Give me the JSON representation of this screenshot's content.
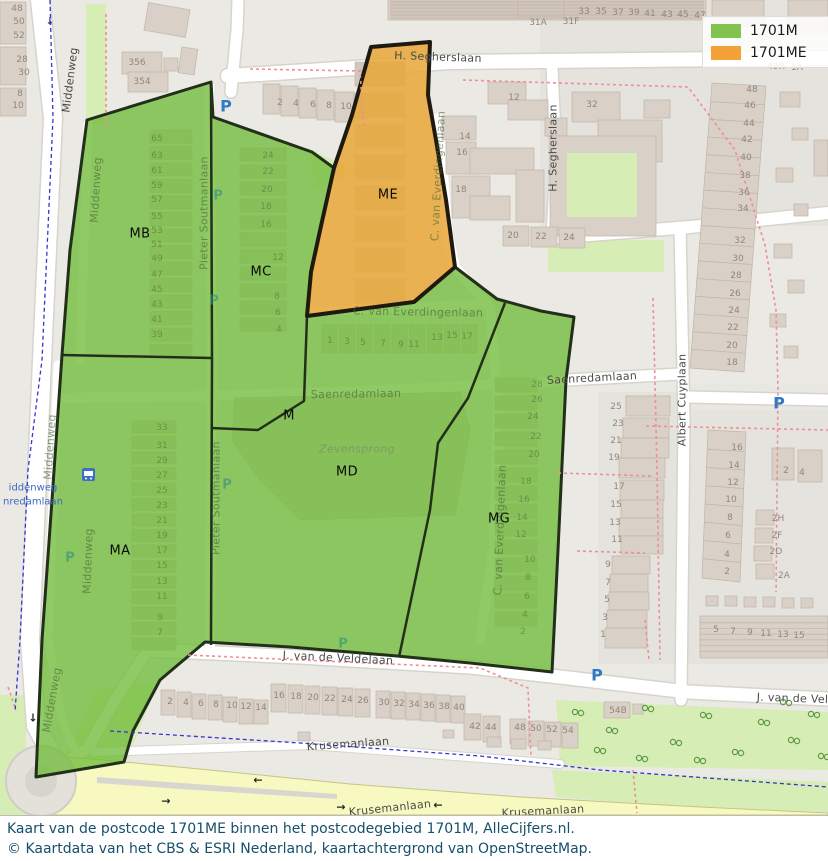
{
  "legend": {
    "items": [
      {
        "label": "1701M",
        "color": "#82c24e"
      },
      {
        "label": "1701ME",
        "color": "#f4a137"
      }
    ]
  },
  "caption": {
    "line1": "Kaart van de postcode 1701ME binnen het postcodegebied 1701M, AlleCijfers.nl.",
    "line2": "© Kaartdata van het CBS & ESRI Nederland, kaartachtergrond van OpenStreetMap."
  },
  "colors": {
    "area_1701M": "#74bd3f",
    "area_1701ME": "#e8a93c",
    "boundary_dark": "#22301a",
    "postcode_boundary_dashed": "#ef8e97",
    "cycleway_dashed": "#3535cf",
    "caption_text": "#16506b",
    "parking_icon": "#2e7ac5"
  },
  "regions": [
    {
      "code": "MB",
      "x": 140,
      "y": 234
    },
    {
      "code": "MC",
      "x": 261,
      "y": 272
    },
    {
      "code": "ME",
      "x": 388,
      "y": 195
    },
    {
      "code": "M",
      "x": 289,
      "y": 416
    },
    {
      "code": "MD",
      "x": 347,
      "y": 472
    },
    {
      "code": "MA",
      "x": 120,
      "y": 551
    },
    {
      "code": "MG",
      "x": 499,
      "y": 519
    }
  ],
  "streets": [
    {
      "t": "Middenweg",
      "x": 70,
      "y": 80,
      "r": -83,
      "v": "main"
    },
    {
      "t": "Middenweg",
      "x": 96,
      "y": 190,
      "r": -87,
      "v": "faint"
    },
    {
      "t": "Middenweg",
      "x": 50,
      "y": 447,
      "r": -86,
      "v": "faint"
    },
    {
      "t": "Middenweg",
      "x": 88,
      "y": 561,
      "r": -88,
      "v": "faint"
    },
    {
      "t": "Middenweg",
      "x": 52,
      "y": 700,
      "r": -80,
      "v": "faint"
    },
    {
      "t": "H. Segherslaan",
      "x": 438,
      "y": 57,
      "r": 2,
      "v": "main"
    },
    {
      "t": "H. Segherslaan",
      "x": 553,
      "y": 148,
      "r": -90,
      "v": "main"
    },
    {
      "t": "Pieter Soutmanlaan",
      "x": 204,
      "y": 213,
      "r": -90,
      "v": "faint"
    },
    {
      "t": "Pieter Soutmanlaan",
      "x": 216,
      "y": 498,
      "r": -90,
      "v": "faint"
    },
    {
      "t": "C. van Everdingenlaan",
      "x": 438,
      "y": 176,
      "r": -87,
      "v": "faint"
    },
    {
      "t": "C. van Everdingenlaan",
      "x": 418,
      "y": 312,
      "r": 1,
      "v": "faint"
    },
    {
      "t": "C. van Everdingenlaan",
      "x": 500,
      "y": 530,
      "r": -88,
      "v": "faint"
    },
    {
      "t": "Saenredamlaan",
      "x": 356,
      "y": 394,
      "r": -1,
      "v": "faint"
    },
    {
      "t": "Saenredamlaan",
      "x": 592,
      "y": 378,
      "r": -3,
      "v": "main"
    },
    {
      "t": "Albert Cuyplaan",
      "x": 682,
      "y": 400,
      "r": -90,
      "v": "main"
    },
    {
      "t": "Zevensprong",
      "x": 357,
      "y": 449,
      "r": 0,
      "v": "place"
    },
    {
      "t": "J. van de Veldelaan",
      "x": 338,
      "y": 658,
      "r": 3,
      "v": "main"
    },
    {
      "t": "J. van de Veldelaan",
      "x": 812,
      "y": 699,
      "r": 2,
      "v": "main"
    },
    {
      "t": "Krusemanlaan",
      "x": 348,
      "y": 744,
      "r": -4,
      "v": "main"
    },
    {
      "t": "Krusemanlaan",
      "x": 390,
      "y": 808,
      "r": -6,
      "v": "main"
    },
    {
      "t": "Krusemanlaan",
      "x": 543,
      "y": 811,
      "r": -3,
      "v": "main"
    }
  ],
  "bus_stop": {
    "line1": "iddenweg",
    "line2": "nredamlaan"
  },
  "pois": [
    {
      "t": "P",
      "x": 226,
      "y": 106,
      "cls": "pblue",
      "name": "parking-icon"
    },
    {
      "t": "P",
      "x": 779,
      "y": 403,
      "cls": "pblue",
      "name": "parking-icon"
    },
    {
      "t": "P",
      "x": 597,
      "y": 675,
      "cls": "pblue",
      "name": "parking-icon"
    },
    {
      "t": "P",
      "x": 218,
      "y": 196,
      "cls": "pteal",
      "name": "parking-icon"
    },
    {
      "t": "P",
      "x": 214,
      "y": 301,
      "cls": "pteal",
      "name": "parking-icon"
    },
    {
      "t": "P",
      "x": 227,
      "y": 485,
      "cls": "pteal",
      "name": "parking-icon"
    },
    {
      "t": "P",
      "x": 70,
      "y": 558,
      "cls": "pteal",
      "name": "parking-icon"
    },
    {
      "t": "P",
      "x": 343,
      "y": 644,
      "cls": "pteal",
      "name": "parking-icon"
    },
    {
      "t": "←",
      "x": 258,
      "y": 780,
      "cls": "arrow",
      "name": "oneway-arrow-icon"
    },
    {
      "t": "→",
      "x": 166,
      "y": 801,
      "cls": "arrow",
      "name": "oneway-arrow-icon"
    },
    {
      "t": "←",
      "x": 438,
      "y": 805,
      "cls": "arrow",
      "name": "oneway-arrow-icon"
    },
    {
      "t": "→",
      "x": 341,
      "y": 807,
      "cls": "arrow",
      "name": "oneway-arrow-icon"
    },
    {
      "t": "↓",
      "x": 33,
      "y": 718,
      "cls": "arrow",
      "name": "oneway-arrow-icon"
    },
    {
      "t": "↓",
      "x": 50,
      "y": 22,
      "cls": "arrowblue",
      "name": "path-arrow-icon"
    }
  ],
  "house_numbers": [
    {
      "t": "48",
      "x": 17,
      "y": 9
    },
    {
      "t": "50",
      "x": 19,
      "y": 22
    },
    {
      "t": "52",
      "x": 19,
      "y": 36
    },
    {
      "t": "28",
      "x": 22,
      "y": 60
    },
    {
      "t": "30",
      "x": 24,
      "y": 73
    },
    {
      "t": "8",
      "x": 20,
      "y": 94
    },
    {
      "t": "10",
      "x": 18,
      "y": 106
    },
    {
      "t": "356",
      "x": 137,
      "y": 63
    },
    {
      "t": "354",
      "x": 142,
      "y": 82
    },
    {
      "t": "2",
      "x": 280,
      "y": 103
    },
    {
      "t": "4",
      "x": 296,
      "y": 104
    },
    {
      "t": "6",
      "x": 313,
      "y": 105
    },
    {
      "t": "8",
      "x": 329,
      "y": 106
    },
    {
      "t": "10",
      "x": 346,
      "y": 107
    },
    {
      "t": "31A",
      "x": 538,
      "y": 23
    },
    {
      "t": "31F",
      "x": 571,
      "y": 22
    },
    {
      "t": "33",
      "x": 584,
      "y": 12
    },
    {
      "t": "35",
      "x": 601,
      "y": 12
    },
    {
      "t": "37",
      "x": 618,
      "y": 13
    },
    {
      "t": "39",
      "x": 634,
      "y": 13
    },
    {
      "t": "41",
      "x": 650,
      "y": 14
    },
    {
      "t": "43",
      "x": 667,
      "y": 15
    },
    {
      "t": "45",
      "x": 683,
      "y": 15
    },
    {
      "t": "47",
      "x": 700,
      "y": 16
    },
    {
      "t": "49R",
      "x": 776,
      "y": 67
    },
    {
      "t": "1A",
      "x": 797,
      "y": 68
    },
    {
      "t": "12",
      "x": 514,
      "y": 98
    },
    {
      "t": "32",
      "x": 592,
      "y": 105
    },
    {
      "t": "14",
      "x": 465,
      "y": 137
    },
    {
      "t": "16",
      "x": 462,
      "y": 153
    },
    {
      "t": "18",
      "x": 461,
      "y": 190
    },
    {
      "t": "20",
      "x": 513,
      "y": 236
    },
    {
      "t": "22",
      "x": 541,
      "y": 237
    },
    {
      "t": "24",
      "x": 569,
      "y": 238
    },
    {
      "t": "48",
      "x": 752,
      "y": 90
    },
    {
      "t": "46",
      "x": 750,
      "y": 106
    },
    {
      "t": "44",
      "x": 749,
      "y": 124
    },
    {
      "t": "42",
      "x": 747,
      "y": 140
    },
    {
      "t": "40",
      "x": 746,
      "y": 158
    },
    {
      "t": "38",
      "x": 745,
      "y": 176
    },
    {
      "t": "36",
      "x": 744,
      "y": 193
    },
    {
      "t": "34",
      "x": 743,
      "y": 209
    },
    {
      "t": "32",
      "x": 740,
      "y": 241
    },
    {
      "t": "30",
      "x": 738,
      "y": 259
    },
    {
      "t": "28",
      "x": 736,
      "y": 276
    },
    {
      "t": "26",
      "x": 735,
      "y": 294
    },
    {
      "t": "24",
      "x": 734,
      "y": 311
    },
    {
      "t": "22",
      "x": 733,
      "y": 328
    },
    {
      "t": "20",
      "x": 732,
      "y": 346
    },
    {
      "t": "18",
      "x": 732,
      "y": 363
    },
    {
      "t": "25",
      "x": 616,
      "y": 407
    },
    {
      "t": "23",
      "x": 618,
      "y": 424
    },
    {
      "t": "21",
      "x": 616,
      "y": 441
    },
    {
      "t": "19",
      "x": 614,
      "y": 458
    },
    {
      "t": "17",
      "x": 619,
      "y": 487
    },
    {
      "t": "15",
      "x": 616,
      "y": 505
    },
    {
      "t": "13",
      "x": 615,
      "y": 523
    },
    {
      "t": "11",
      "x": 617,
      "y": 540
    },
    {
      "t": "9",
      "x": 608,
      "y": 565
    },
    {
      "t": "7",
      "x": 608,
      "y": 583
    },
    {
      "t": "5",
      "x": 607,
      "y": 600
    },
    {
      "t": "3",
      "x": 605,
      "y": 618
    },
    {
      "t": "1",
      "x": 603,
      "y": 635
    },
    {
      "t": "16",
      "x": 737,
      "y": 448
    },
    {
      "t": "14",
      "x": 734,
      "y": 466
    },
    {
      "t": "12",
      "x": 733,
      "y": 483
    },
    {
      "t": "10",
      "x": 731,
      "y": 500
    },
    {
      "t": "8",
      "x": 730,
      "y": 518
    },
    {
      "t": "6",
      "x": 728,
      "y": 536
    },
    {
      "t": "4",
      "x": 727,
      "y": 555
    },
    {
      "t": "2",
      "x": 727,
      "y": 572
    },
    {
      "t": "2H",
      "x": 778,
      "y": 519
    },
    {
      "t": "2F",
      "x": 777,
      "y": 536
    },
    {
      "t": "2D",
      "x": 776,
      "y": 552
    },
    {
      "t": "2A",
      "x": 784,
      "y": 576
    },
    {
      "t": "2",
      "x": 786,
      "y": 471
    },
    {
      "t": "4",
      "x": 802,
      "y": 473
    },
    {
      "t": "5",
      "x": 716,
      "y": 630
    },
    {
      "t": "7",
      "x": 733,
      "y": 632
    },
    {
      "t": "9",
      "x": 750,
      "y": 633
    },
    {
      "t": "11",
      "x": 766,
      "y": 634
    },
    {
      "t": "13",
      "x": 783,
      "y": 635
    },
    {
      "t": "15",
      "x": 799,
      "y": 636
    },
    {
      "t": "2",
      "x": 170,
      "y": 702
    },
    {
      "t": "4",
      "x": 186,
      "y": 703
    },
    {
      "t": "6",
      "x": 201,
      "y": 704
    },
    {
      "t": "8",
      "x": 216,
      "y": 705
    },
    {
      "t": "10",
      "x": 232,
      "y": 706
    },
    {
      "t": "12",
      "x": 246,
      "y": 707
    },
    {
      "t": "14",
      "x": 261,
      "y": 708
    },
    {
      "t": "16",
      "x": 279,
      "y": 696
    },
    {
      "t": "18",
      "x": 296,
      "y": 697
    },
    {
      "t": "20",
      "x": 313,
      "y": 698
    },
    {
      "t": "22",
      "x": 330,
      "y": 699
    },
    {
      "t": "24",
      "x": 347,
      "y": 700
    },
    {
      "t": "26",
      "x": 363,
      "y": 701
    },
    {
      "t": "30",
      "x": 384,
      "y": 703
    },
    {
      "t": "32",
      "x": 399,
      "y": 704
    },
    {
      "t": "34",
      "x": 414,
      "y": 705
    },
    {
      "t": "36",
      "x": 429,
      "y": 706
    },
    {
      "t": "38",
      "x": 444,
      "y": 707
    },
    {
      "t": "40",
      "x": 459,
      "y": 708
    },
    {
      "t": "42",
      "x": 475,
      "y": 727
    },
    {
      "t": "44",
      "x": 491,
      "y": 728
    },
    {
      "t": "48",
      "x": 520,
      "y": 728
    },
    {
      "t": "50",
      "x": 536,
      "y": 729
    },
    {
      "t": "52",
      "x": 552,
      "y": 730
    },
    {
      "t": "54",
      "x": 568,
      "y": 731
    },
    {
      "t": "54B",
      "x": 618,
      "y": 711
    },
    {
      "t": "65",
      "x": 157,
      "y": 139,
      "f": 1
    },
    {
      "t": "63",
      "x": 157,
      "y": 156,
      "f": 1
    },
    {
      "t": "61",
      "x": 157,
      "y": 171,
      "f": 1
    },
    {
      "t": "59",
      "x": 157,
      "y": 186,
      "f": 1
    },
    {
      "t": "57",
      "x": 157,
      "y": 200,
      "f": 1
    },
    {
      "t": "55",
      "x": 157,
      "y": 217,
      "f": 1
    },
    {
      "t": "53",
      "x": 157,
      "y": 231,
      "f": 1
    },
    {
      "t": "51",
      "x": 157,
      "y": 245,
      "f": 1
    },
    {
      "t": "49",
      "x": 157,
      "y": 259,
      "f": 1
    },
    {
      "t": "47",
      "x": 157,
      "y": 275,
      "f": 1
    },
    {
      "t": "45",
      "x": 157,
      "y": 290,
      "f": 1
    },
    {
      "t": "43",
      "x": 157,
      "y": 305,
      "f": 1
    },
    {
      "t": "41",
      "x": 157,
      "y": 320,
      "f": 1
    },
    {
      "t": "39",
      "x": 157,
      "y": 335,
      "f": 1
    },
    {
      "t": "24",
      "x": 268,
      "y": 156,
      "f": 1
    },
    {
      "t": "22",
      "x": 268,
      "y": 172,
      "f": 1
    },
    {
      "t": "20",
      "x": 267,
      "y": 190,
      "f": 1
    },
    {
      "t": "18",
      "x": 266,
      "y": 207,
      "f": 1
    },
    {
      "t": "16",
      "x": 266,
      "y": 225,
      "f": 1
    },
    {
      "t": "12",
      "x": 278,
      "y": 258,
      "f": 1
    },
    {
      "t": "8",
      "x": 277,
      "y": 297,
      "f": 1
    },
    {
      "t": "6",
      "x": 278,
      "y": 313,
      "f": 1
    },
    {
      "t": "4",
      "x": 279,
      "y": 330,
      "f": 1
    },
    {
      "t": "33",
      "x": 162,
      "y": 428,
      "f": 1
    },
    {
      "t": "31",
      "x": 162,
      "y": 446,
      "f": 1
    },
    {
      "t": "29",
      "x": 162,
      "y": 461,
      "f": 1
    },
    {
      "t": "27",
      "x": 162,
      "y": 476,
      "f": 1
    },
    {
      "t": "25",
      "x": 162,
      "y": 491,
      "f": 1
    },
    {
      "t": "23",
      "x": 162,
      "y": 506,
      "f": 1
    },
    {
      "t": "21",
      "x": 162,
      "y": 521,
      "f": 1
    },
    {
      "t": "19",
      "x": 162,
      "y": 536,
      "f": 1
    },
    {
      "t": "17",
      "x": 162,
      "y": 551,
      "f": 1
    },
    {
      "t": "15",
      "x": 162,
      "y": 566,
      "f": 1
    },
    {
      "t": "13",
      "x": 162,
      "y": 582,
      "f": 1
    },
    {
      "t": "11",
      "x": 162,
      "y": 597,
      "f": 1
    },
    {
      "t": "9",
      "x": 160,
      "y": 618,
      "f": 1
    },
    {
      "t": "7",
      "x": 160,
      "y": 633,
      "f": 1
    },
    {
      "t": "1",
      "x": 330,
      "y": 341,
      "f": 1
    },
    {
      "t": "3",
      "x": 347,
      "y": 342,
      "f": 1
    },
    {
      "t": "5",
      "x": 363,
      "y": 343,
      "f": 1
    },
    {
      "t": "7",
      "x": 383,
      "y": 344,
      "f": 1
    },
    {
      "t": "9",
      "x": 401,
      "y": 345,
      "f": 1
    },
    {
      "t": "11",
      "x": 414,
      "y": 345,
      "f": 1
    },
    {
      "t": "13",
      "x": 437,
      "y": 338,
      "f": 1
    },
    {
      "t": "15",
      "x": 452,
      "y": 336,
      "f": 1
    },
    {
      "t": "17",
      "x": 467,
      "y": 337,
      "f": 1
    },
    {
      "t": "28",
      "x": 537,
      "y": 385,
      "f": 1
    },
    {
      "t": "26",
      "x": 537,
      "y": 400,
      "f": 1
    },
    {
      "t": "24",
      "x": 533,
      "y": 417,
      "f": 1
    },
    {
      "t": "22",
      "x": 536,
      "y": 437,
      "f": 1
    },
    {
      "t": "20",
      "x": 534,
      "y": 455,
      "f": 1
    },
    {
      "t": "18",
      "x": 526,
      "y": 482,
      "f": 1
    },
    {
      "t": "16",
      "x": 524,
      "y": 500,
      "f": 1
    },
    {
      "t": "14",
      "x": 522,
      "y": 518,
      "f": 1
    },
    {
      "t": "12",
      "x": 521,
      "y": 535,
      "f": 1
    },
    {
      "t": "10",
      "x": 530,
      "y": 560,
      "f": 1
    },
    {
      "t": "8",
      "x": 528,
      "y": 578,
      "f": 1
    },
    {
      "t": "6",
      "x": 527,
      "y": 597,
      "f": 1
    },
    {
      "t": "4",
      "x": 525,
      "y": 615,
      "f": 1
    },
    {
      "t": "2",
      "x": 523,
      "y": 632,
      "f": 1
    }
  ]
}
